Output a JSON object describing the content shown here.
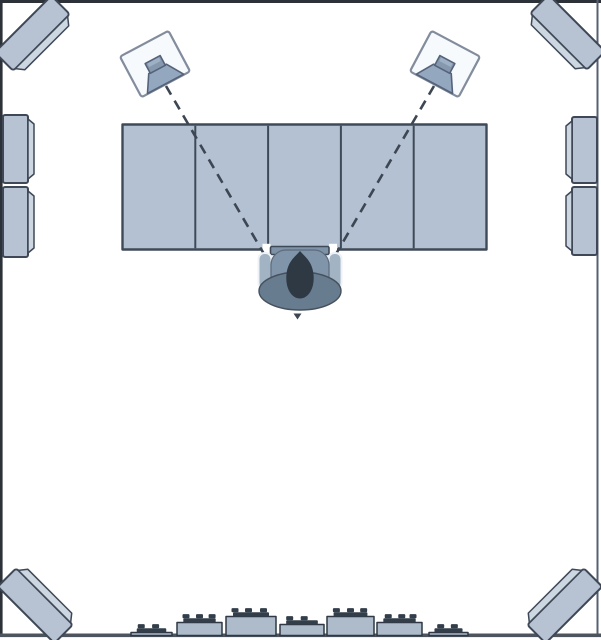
{
  "meta": {
    "description": "Top-down diagram of a studio control room with acoustic treatment: corner bass traps, side wall absorber panels, two angled monitor speakers, a five-section desk, a seated listener in a chair, and a skyline diffuser on the rear wall",
    "room_px": {
      "width": 601,
      "height": 640
    }
  },
  "colors": {
    "background": "#ffffff",
    "wall_line": "#2d3238",
    "wall_line_right": "#586070",
    "baseline": "#4d545e",
    "panel_face": "#b7c3d3",
    "panel_bevel": "#cdd7e2",
    "panel_outline": "#3e4857",
    "desk_fill": "#b4c1d2",
    "desk_outline": "#3f4a58",
    "speaker_cabinet": "#f7fafc",
    "speaker_outline": "#828c9c",
    "cone_fill": "#93a7bf",
    "cone_dark": "#8598ae",
    "cone_top": "#9db0c4",
    "cone_outline": "#55637a",
    "sightline": "#3d4653",
    "head": "#2e3944",
    "torso": "#8095aa",
    "torso_outline": "#5d6b7c",
    "chair": "#687c90",
    "chair_outline": "#46515e",
    "armrest": "#a2b3c4",
    "armrest_outline": "#eef2f7",
    "tray": "#7e93a7",
    "block_fill": "#aebbca",
    "block_outline": "#2f3844",
    "stud": "#333e4b"
  },
  "objects": {
    "corner_bass_traps": {
      "count": 4,
      "positions": [
        "top-left",
        "top-right",
        "bottom-left",
        "bottom-right"
      ]
    },
    "side_absorber_panels": {
      "left_wall": 2,
      "right_wall": 2
    },
    "monitor_speakers": {
      "count": 2,
      "toe_in_deg": 28
    },
    "desk": {
      "sections": 5
    },
    "listener": {
      "seated": true,
      "facing": "front-wall"
    },
    "rear_skyline_diffuser": {
      "blocks": 7
    }
  },
  "desk": {
    "x": 122.5,
    "y": 124.5,
    "w": 364,
    "h": 125,
    "dividers_x": [
      195.3,
      268.1,
      340.9,
      413.7
    ]
  },
  "sightlines": [
    {
      "x1": 166,
      "y1": 86,
      "x2": 264,
      "y2": 254
    },
    {
      "x1": 434,
      "y1": 86,
      "x2": 336,
      "y2": 254
    }
  ],
  "speakers": [
    {
      "x": 155,
      "y": 64,
      "rot": -28
    },
    {
      "x": 445,
      "y": 64,
      "rot": 28
    }
  ],
  "diffuser": {
    "baseline_y": 635.5,
    "plate_h": 4.2,
    "stud_h": 4.2,
    "stud_w": 7,
    "blocks": [
      {
        "x": 131,
        "w": 41,
        "h": 3,
        "studs": [
          0.25,
          0.6
        ]
      },
      {
        "x": 177,
        "w": 45,
        "h": 13,
        "studs": [
          0.2,
          0.5,
          0.78
        ]
      },
      {
        "x": 226,
        "w": 50,
        "h": 19,
        "studs": [
          0.18,
          0.45,
          0.75
        ]
      },
      {
        "x": 280,
        "w": 44,
        "h": 11,
        "studs": [
          0.22,
          0.55
        ]
      },
      {
        "x": 327,
        "w": 47,
        "h": 19,
        "studs": [
          0.2,
          0.5,
          0.78
        ]
      },
      {
        "x": 377,
        "w": 45,
        "h": 13,
        "studs": [
          0.25,
          0.55,
          0.8
        ]
      },
      {
        "x": 429,
        "w": 39,
        "h": 3,
        "studs": [
          0.3,
          0.65
        ]
      }
    ]
  }
}
